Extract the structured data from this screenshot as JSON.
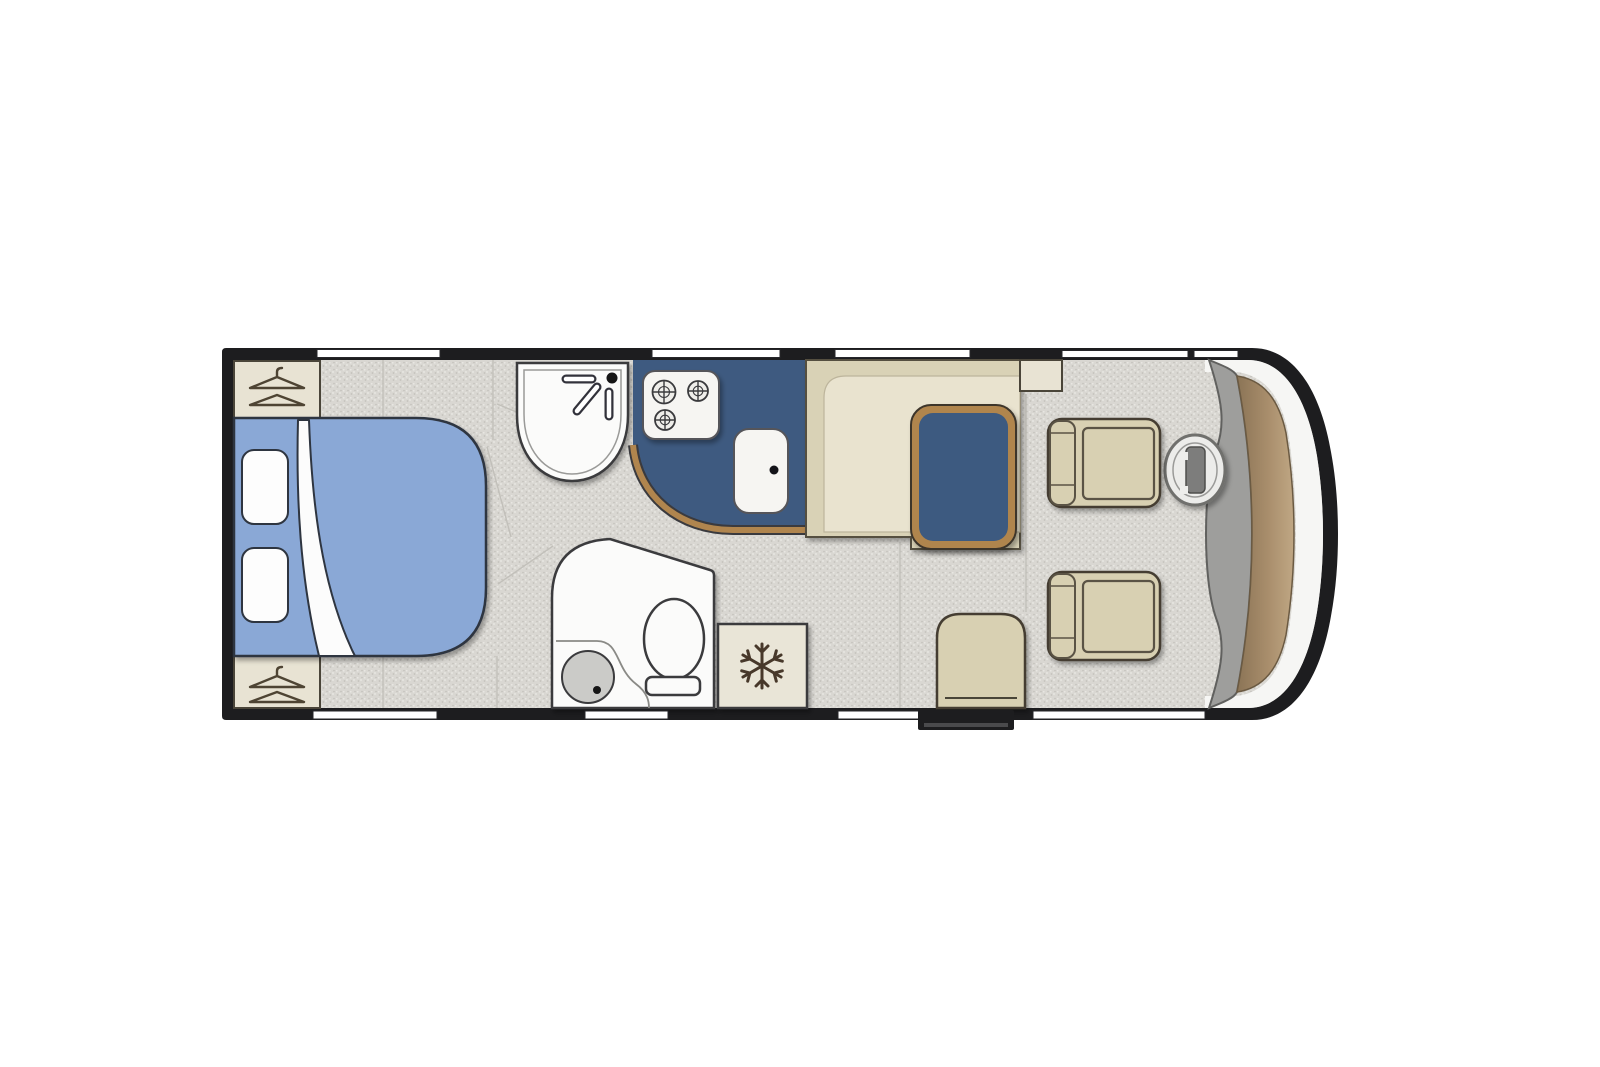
{
  "meta": {
    "title": "Motorhome floor plan",
    "type": "vehicle-floorplan",
    "view": "top-down"
  },
  "palette": {
    "wall": "#1d1d1f",
    "floor_base": "#d9d7d2",
    "speck_dark": "#c3c1bb",
    "speck_light": "#ebeae6",
    "bed_blue": "#8aa8d6",
    "navy": "#3e5a80",
    "wood_trim": "#b0854e",
    "bench_cream": "#d9d2b6",
    "bench_inner": "#e9e3cf",
    "unit_cream": "#e8e3d3",
    "fridge_cream": "#e9e5d7",
    "chair_beige": "#d8d0b2",
    "bath_white": "#fbfbfa",
    "tray_gray": "#cbcbc8",
    "cab_gray": "#9e9e9c",
    "dash_dark": "#8b7456",
    "dash_light": "#c0a784",
    "steel_gray": "#7d7d7b",
    "window_white": "#ffffff",
    "pillow_white": "#fdfdfd",
    "outline": "#2e3440"
  },
  "floorplan": {
    "vehicle": "motorhome",
    "orientation": "cab-at-right, rear-bedroom-at-left",
    "zones": [
      {
        "id": "rear-bedroom",
        "features": [
          "double bed",
          "2 pillows",
          "folded duvet corner",
          "2 wardrobes marked with clothes-hanger symbols",
          "bedside floor shelves"
        ]
      },
      {
        "id": "washroom",
        "features": [
          "corner washbasin with mixer tap",
          "shower tray with drain",
          "toilet with cistern base"
        ]
      },
      {
        "id": "kitchen",
        "features": [
          "3-burner hob",
          "rectangular sink with drain",
          "navy worktop with curved wood-trim edge"
        ]
      },
      {
        "id": "lounge-dinette",
        "features": [
          "cream L-shaped bench",
          "navy table with wood trim",
          "overhead locker",
          "side seat beside entrance"
        ]
      },
      {
        "id": "appliance",
        "features": [
          "refrigerator marked with snowflake symbol"
        ]
      },
      {
        "id": "cab",
        "features": [
          "driver seat",
          "passenger seat",
          "steering wheel",
          "curved dashboard",
          "wrap-around windscreen"
        ]
      }
    ],
    "openings": {
      "top_wall_windows": 4,
      "cab_door_glass_divided": true,
      "bottom_wall_windows": 4,
      "entry_step": true
    }
  }
}
